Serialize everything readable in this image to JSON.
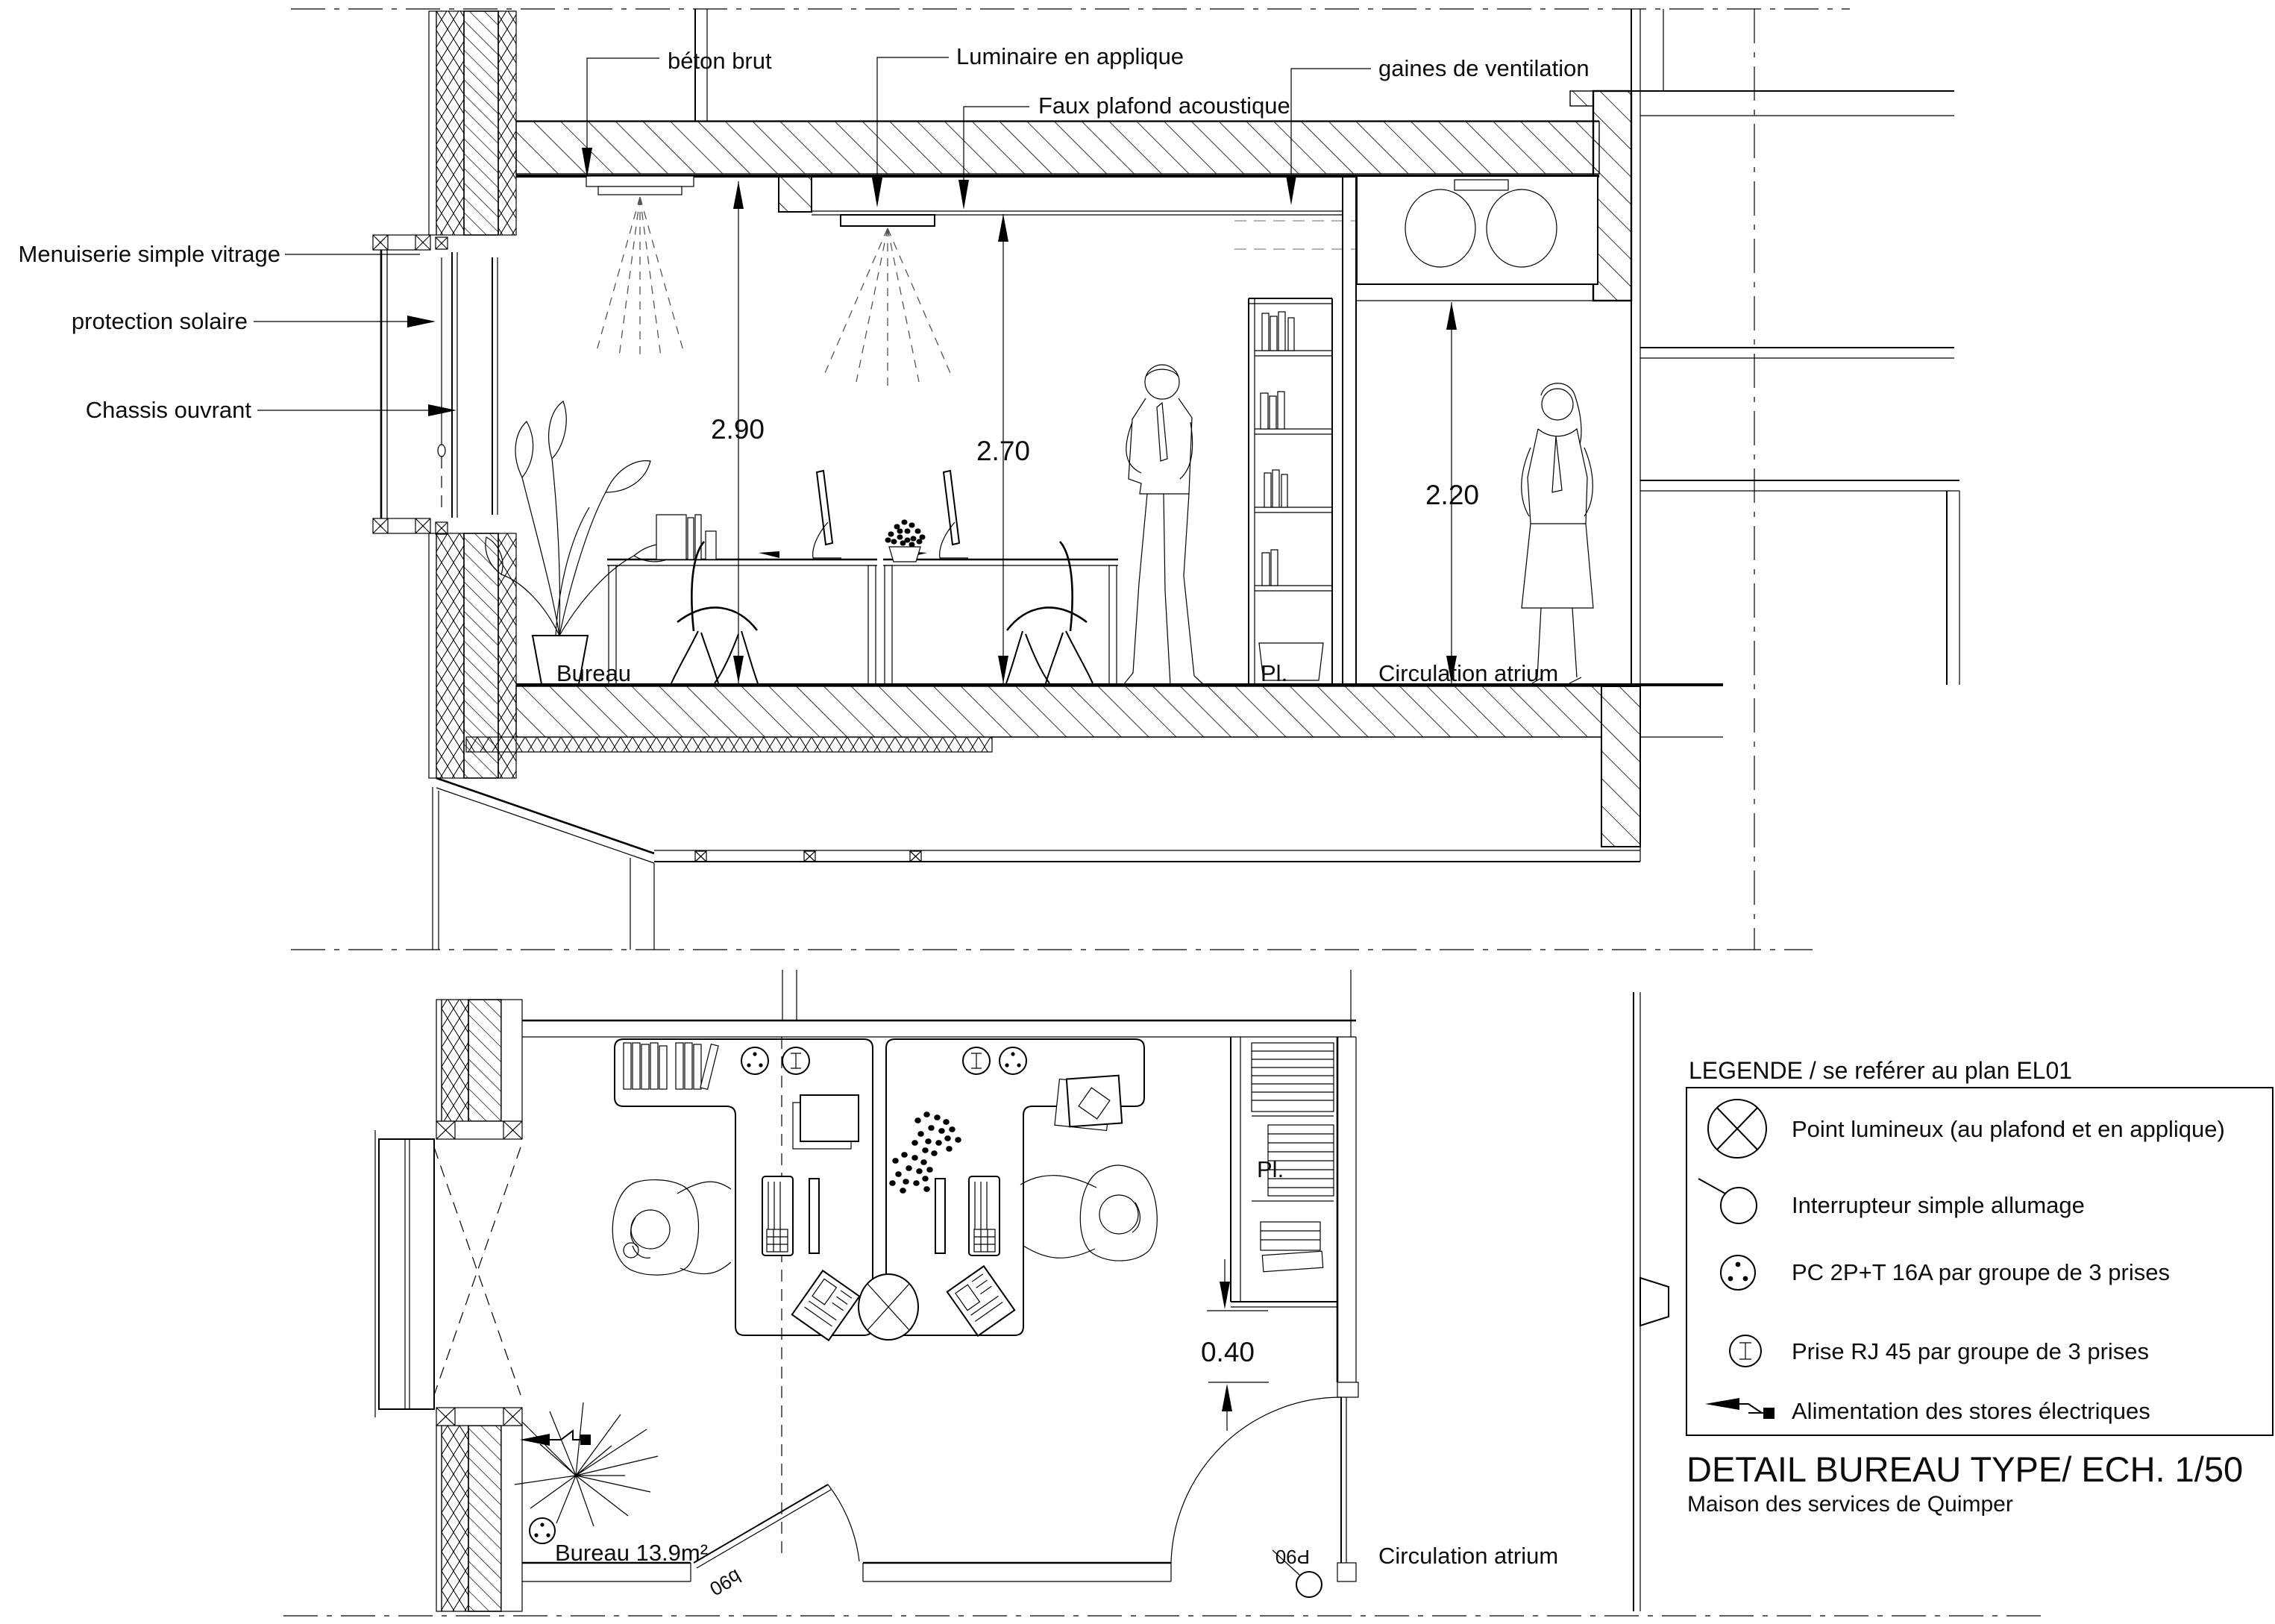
{
  "section": {
    "callouts": {
      "beton_brut": "béton brut",
      "luminaire": "Luminaire en applique",
      "faux_plafond": "Faux plafond acoustique",
      "gaines": "gaines de ventilation",
      "menuiserie": "Menuiserie simple vitrage",
      "protection_solaire": "protection solaire",
      "chassis_ouvrant": "Chassis ouvrant"
    },
    "dimensions": {
      "room_height": "2.90",
      "ceiling_height": "2.70",
      "atrium_height": "2.20"
    },
    "rooms": {
      "bureau": "Bureau",
      "placard": "Pl.",
      "circulation": "Circulation atrium"
    }
  },
  "plan": {
    "rooms": {
      "bureau": "Bureau 13.9m²",
      "placard": "Pl.",
      "circulation": "Circulation atrium"
    },
    "dimensions": {
      "niche_depth": "0.40"
    },
    "doors": {
      "office_door": "b90",
      "corridor_door": "P90"
    }
  },
  "legend": {
    "title": "LEGENDE / se reférer au plan EL01",
    "items": [
      {
        "icon": "point-lumineux",
        "label": "Point lumineux (au plafond et en applique)"
      },
      {
        "icon": "interrupteur",
        "label": "Interrupteur simple allumage"
      },
      {
        "icon": "pc-2pt",
        "label": "PC 2P+T 16A par groupe de 3 prises"
      },
      {
        "icon": "prise-rj45",
        "label": "Prise RJ 45 par groupe de 3 prises"
      },
      {
        "icon": "alimentation-stores",
        "label": "Alimentation des stores électriques"
      }
    ]
  },
  "title_block": {
    "title": "DETAIL BUREAU TYPE/ ECH. 1/50",
    "subtitle": "Maison des services de Quimper"
  },
  "colors": {
    "ink": "#000000",
    "paper": "#ffffff"
  }
}
